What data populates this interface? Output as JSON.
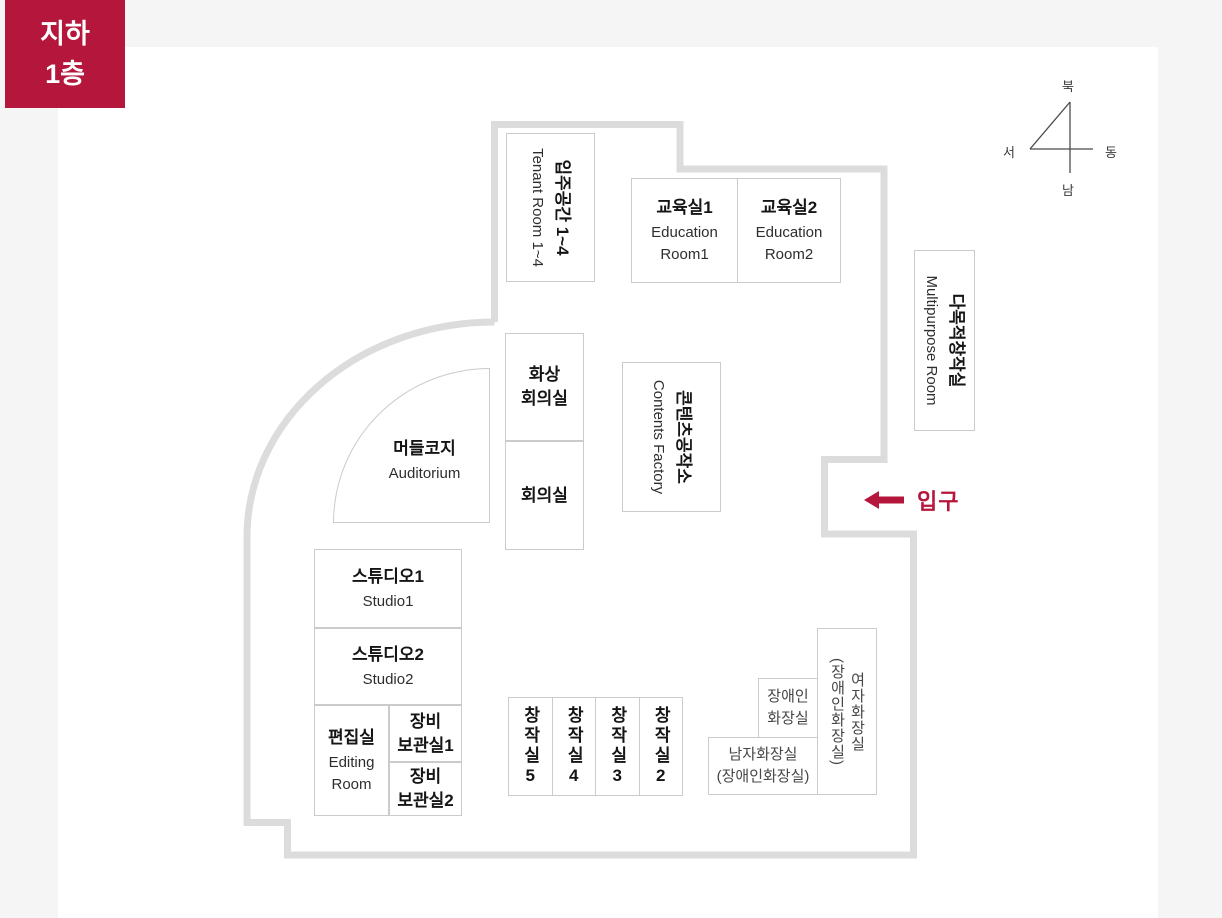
{
  "badge": {
    "label": "지하\n1층"
  },
  "compass": {
    "north": "북",
    "west": "서",
    "east": "동",
    "south": "남"
  },
  "entrance": {
    "label": "입구"
  },
  "rooms": {
    "tenant": {
      "kr": "입주공간 1~4",
      "en": "Tenant Room 1~4"
    },
    "education1": {
      "kr": "교육실1",
      "en": "Education Room1"
    },
    "education2": {
      "kr": "교육실2",
      "en": "Education Room2"
    },
    "multipurpose": {
      "kr": "다목적창작실",
      "en": "Multipurpose Room"
    },
    "video_conference": {
      "kr": "화상\n회의실"
    },
    "meeting": {
      "kr": "회의실"
    },
    "contents_factory": {
      "kr": "콘텐츠공작소",
      "en": "Contents Factory"
    },
    "auditorium": {
      "kr": "머들코지",
      "en": "Auditorium"
    },
    "studio1": {
      "kr": "스튜디오1",
      "en": "Studio1"
    },
    "studio2": {
      "kr": "스튜디오2",
      "en": "Studio2"
    },
    "editing": {
      "kr": "편집실",
      "en": "Editing Room"
    },
    "storage1": {
      "kr": "장비\n보관실1"
    },
    "storage2": {
      "kr": "장비\n보관실2"
    },
    "creation5": {
      "kr": "창작실5"
    },
    "creation4": {
      "kr": "창작실4"
    },
    "creation3": {
      "kr": "창작실3"
    },
    "creation2": {
      "kr": "창작실2"
    },
    "toilet_women": {
      "line1": "여자화장실",
      "line2": "(장애인화장실)"
    },
    "toilet_accessible": {
      "kr": "장애인\n화장실"
    },
    "toilet_men": {
      "kr": "남자화장실\n(장애인화장실)"
    }
  },
  "colors": {
    "accent": "#b5163b",
    "wall": "#dcdcdc",
    "room_border": "#cbcbcb"
  }
}
